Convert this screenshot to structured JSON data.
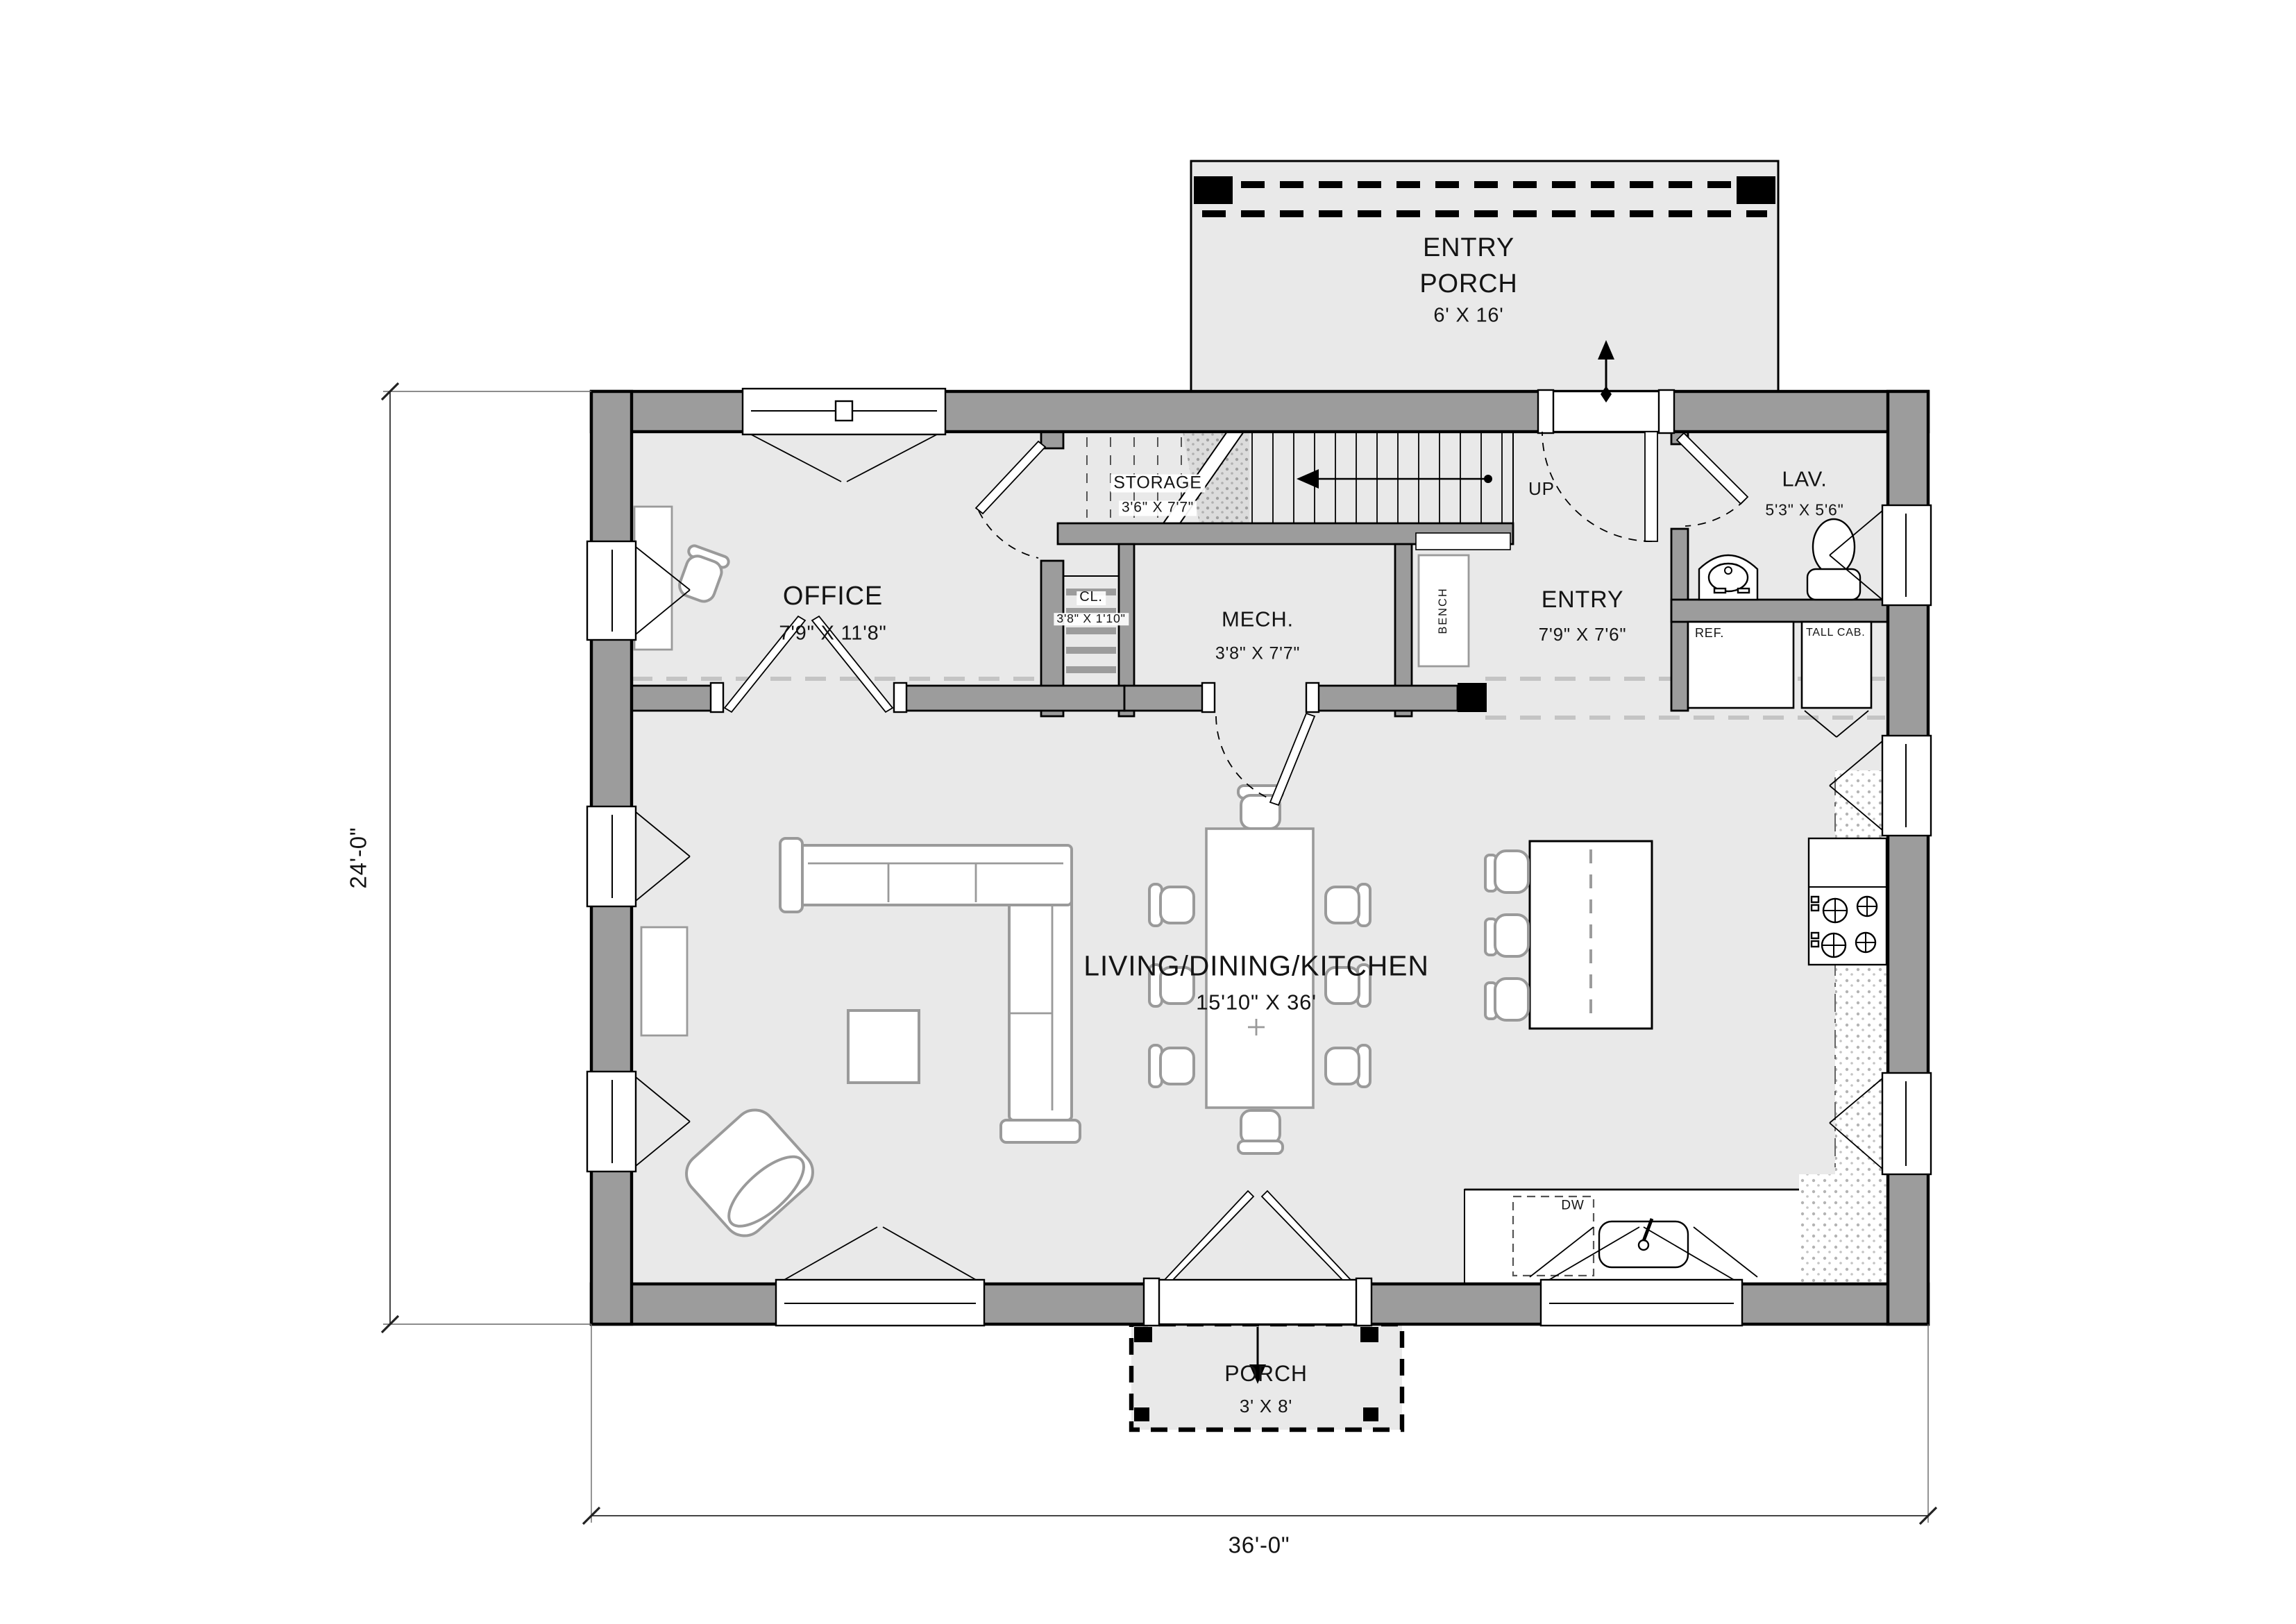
{
  "rooms": {
    "entry_porch": {
      "line1": "ENTRY",
      "line2": "PORCH",
      "dims": "6' X 16'"
    },
    "office": {
      "name": "OFFICE",
      "dims": "7'9\" X 11'8\""
    },
    "storage": {
      "name": "STORAGE",
      "dims": "3'6\" X 7'7\""
    },
    "closet": {
      "name": "CL.",
      "dims": "3'8\" X 1'10\""
    },
    "mech": {
      "name": "MECH.",
      "dims": "3'8\" X 7'7\""
    },
    "entry": {
      "name": "ENTRY",
      "dims": "7'9\" X 7'6\""
    },
    "lav": {
      "name": "LAV.",
      "dims": "5'3\" X 5'6\""
    },
    "living": {
      "name": "LIVING/DINING/KITCHEN",
      "dims": "15'10\" X 36'"
    },
    "porch": {
      "name": "PORCH",
      "dims": "3' X 8'"
    }
  },
  "annotations": {
    "up": "UP",
    "bench": "BENCH",
    "ref": "REF.",
    "tall_cab": "TALL CAB.",
    "dw": "DW"
  },
  "dimensions": {
    "width": "36'-0\"",
    "height": "24'-0\""
  },
  "colors": {
    "wall": "#9c9c9c",
    "floor": "#e9e9e9",
    "outline": "#000000",
    "furniture": "#9a9a9a",
    "dashed_ref": "#c4c4c4"
  }
}
